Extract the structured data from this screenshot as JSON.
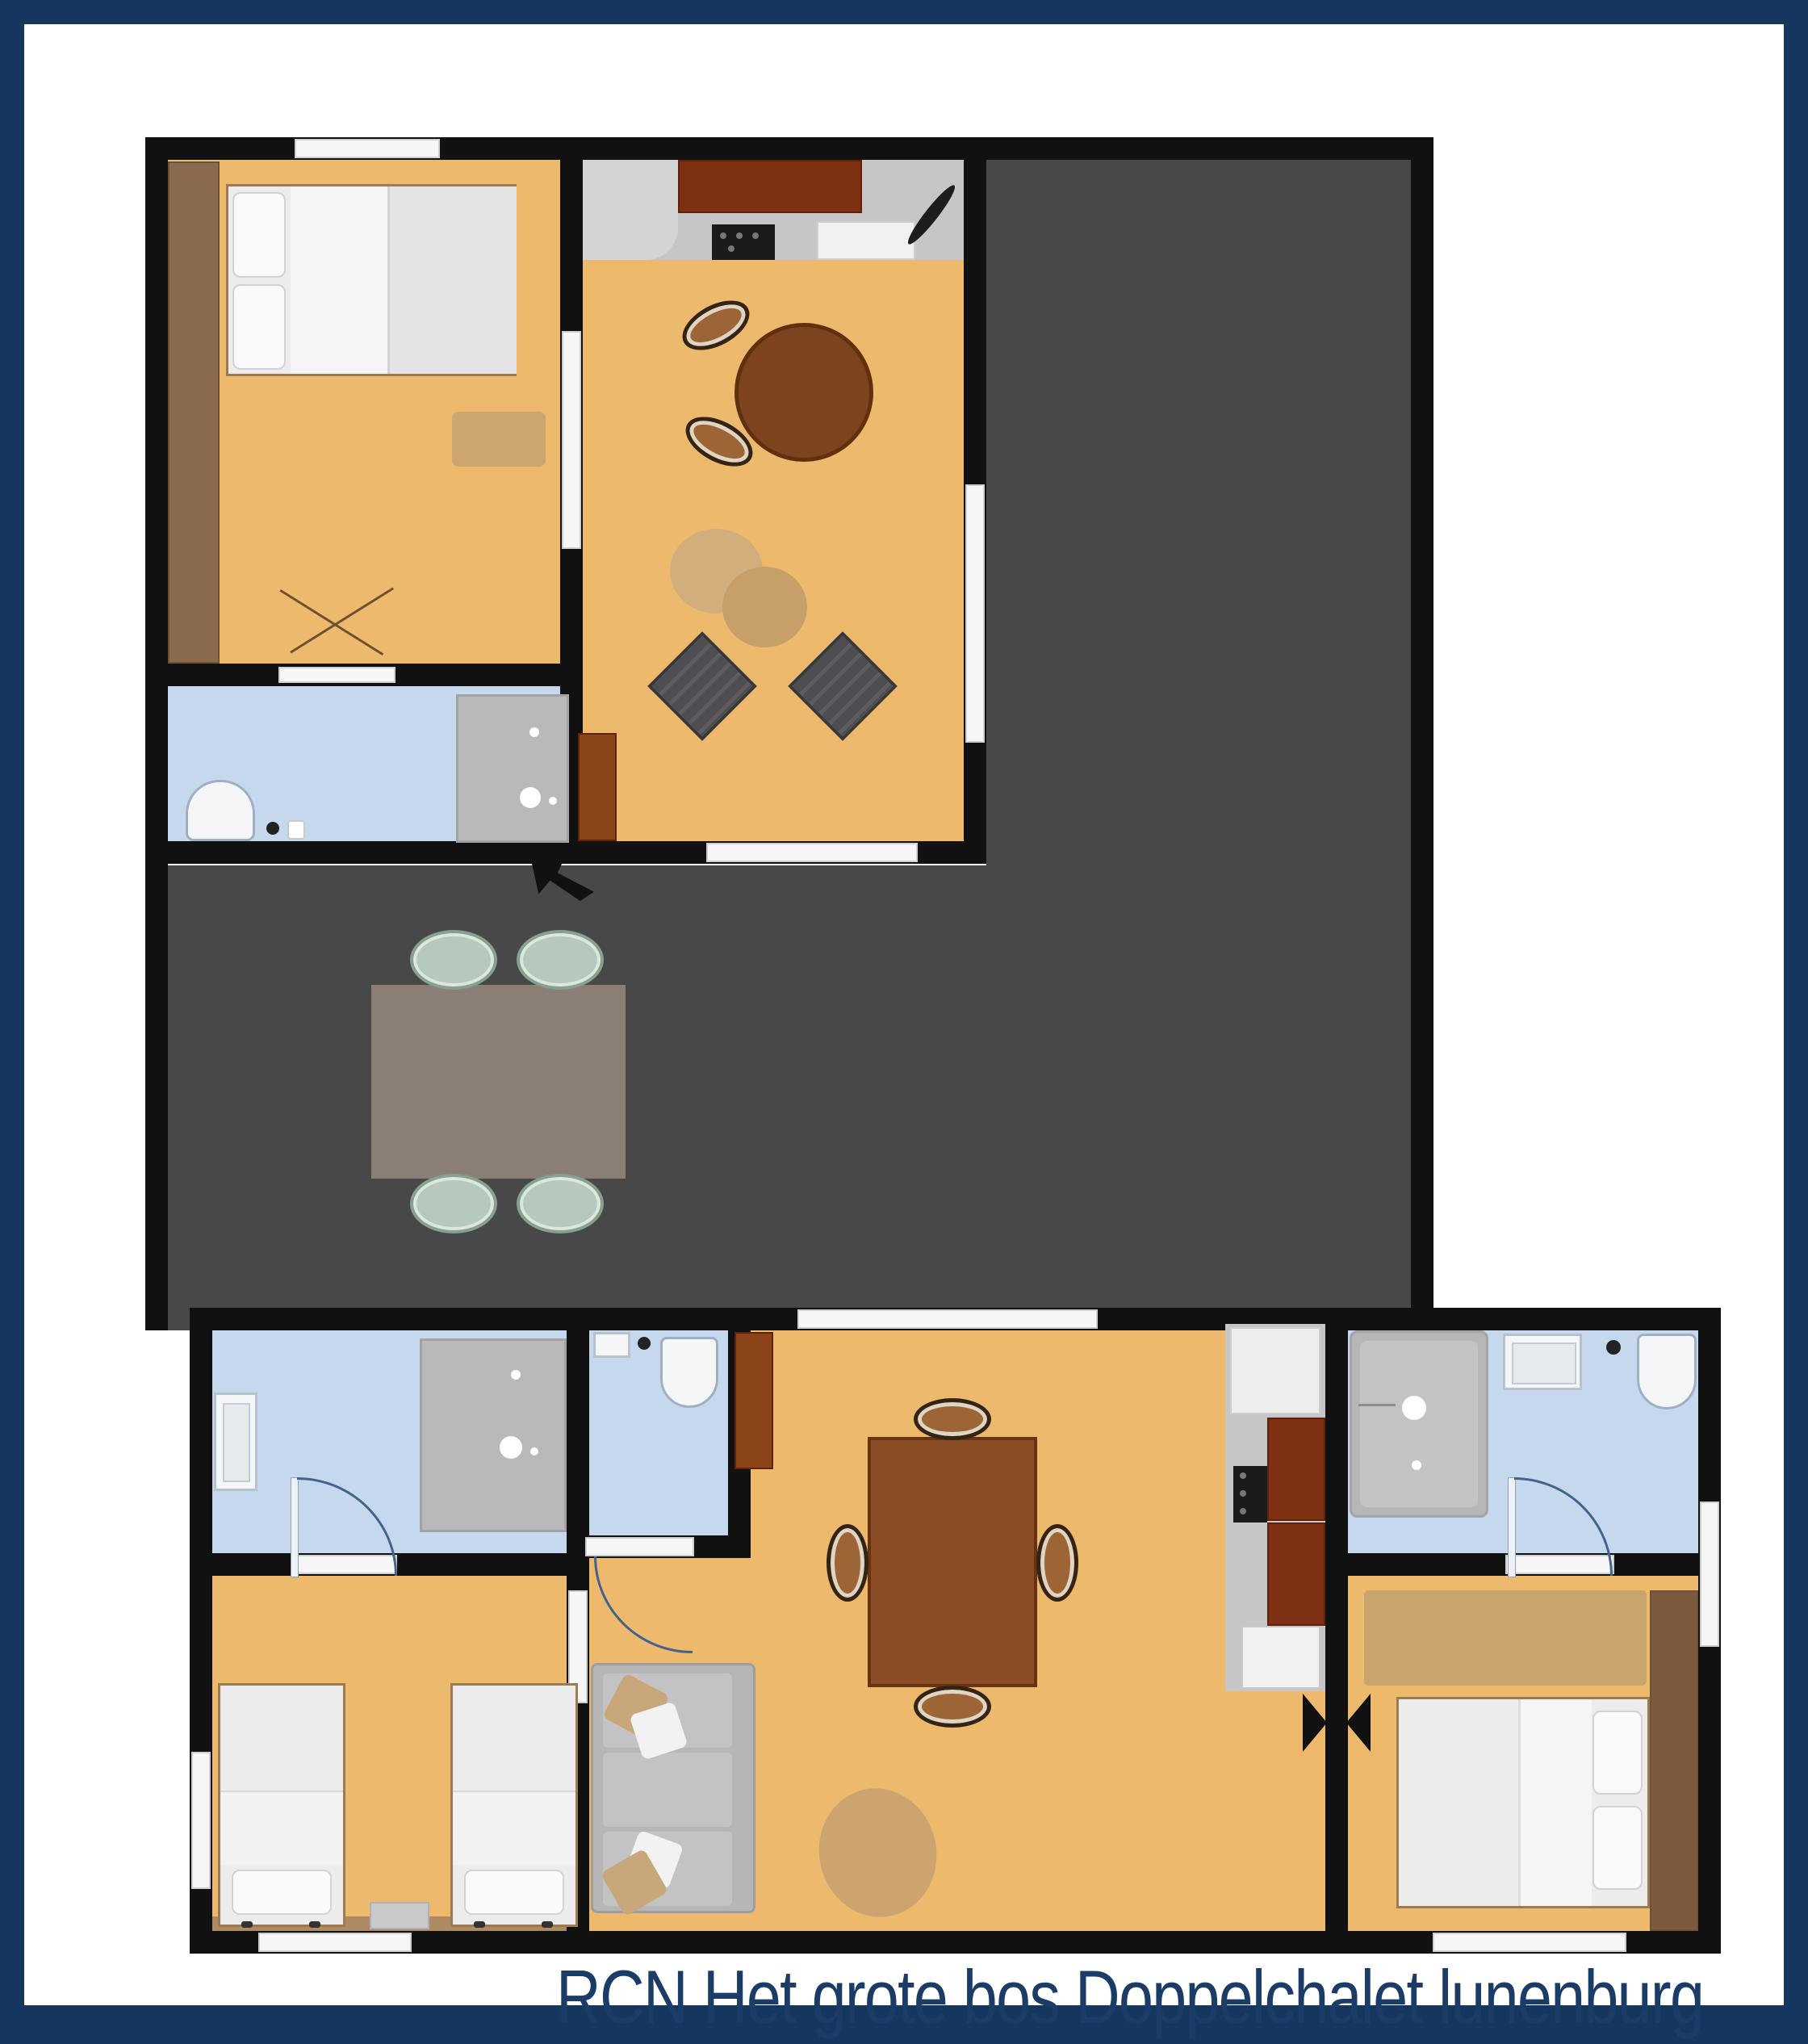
{
  "caption": "RCN Het grote bos Doppelchalet lunenburg",
  "colors": {
    "frame": "#15375f",
    "caption_text": "#1a3c66",
    "wall": "#111111",
    "room_floor": "#edb96d",
    "bathroom_floor": "#c5d8ee",
    "terrace_floor": "#484848",
    "kitchen_counter": "#c6c6c8",
    "cabinet_brown": "#7e3013",
    "wardrobe_wood": "#8a6a4e",
    "table_wood": "#8a4d26",
    "outdoor_table": "#8b7e74",
    "outdoor_chair": "#b7c8bc",
    "sofa": "#b6b6b8",
    "armchair": "#4e4e52",
    "bed": "#ececec",
    "rug": "#d2ae7c",
    "shower": "#b9b9bb",
    "door_swing": "#46628c"
  },
  "floorplan": {
    "units": [
      {
        "id": "upper-chalet",
        "rooms": [
          {
            "id": "bedroom-top-left",
            "furniture": [
              "wardrobe",
              "double-bed",
              "rug",
              "window",
              "door"
            ]
          },
          {
            "id": "bathroom-top-left",
            "furniture": [
              "toilet",
              "shower",
              "door"
            ]
          },
          {
            "id": "kitchen-living-top",
            "furniture": [
              "kitchen-counter",
              "cooktop",
              "round-table",
              "two-chairs",
              "rug",
              "two-armchairs",
              "cabinet",
              "sliding-door",
              "window"
            ]
          }
        ]
      },
      {
        "id": "terrace",
        "furniture": [
          "outdoor-table",
          "four-outdoor-chairs",
          "entrance-arrow"
        ]
      },
      {
        "id": "lower-chalet",
        "rooms": [
          {
            "id": "bathroom-bottom-left",
            "furniture": [
              "sink",
              "shower",
              "door-swing"
            ]
          },
          {
            "id": "toilet-room-bottom",
            "furniture": [
              "toilet",
              "sink",
              "door-swing"
            ]
          },
          {
            "id": "living-kitchen-bottom",
            "furniture": [
              "cabinet",
              "dining-table",
              "four-chairs",
              "sofa",
              "rug",
              "kitchen-strip",
              "cooktop",
              "sink",
              "entry-door"
            ]
          },
          {
            "id": "bedroom-bottom-left",
            "furniture": [
              "twin-bed",
              "twin-bed",
              "nightstand",
              "window"
            ]
          },
          {
            "id": "bathroom-bottom-right",
            "furniture": [
              "bathtub",
              "sink",
              "toilet",
              "door-swing"
            ]
          },
          {
            "id": "bedroom-bottom-right",
            "furniture": [
              "rug",
              "wardrobe",
              "double-bed",
              "folding-door",
              "window"
            ]
          }
        ]
      }
    ]
  }
}
